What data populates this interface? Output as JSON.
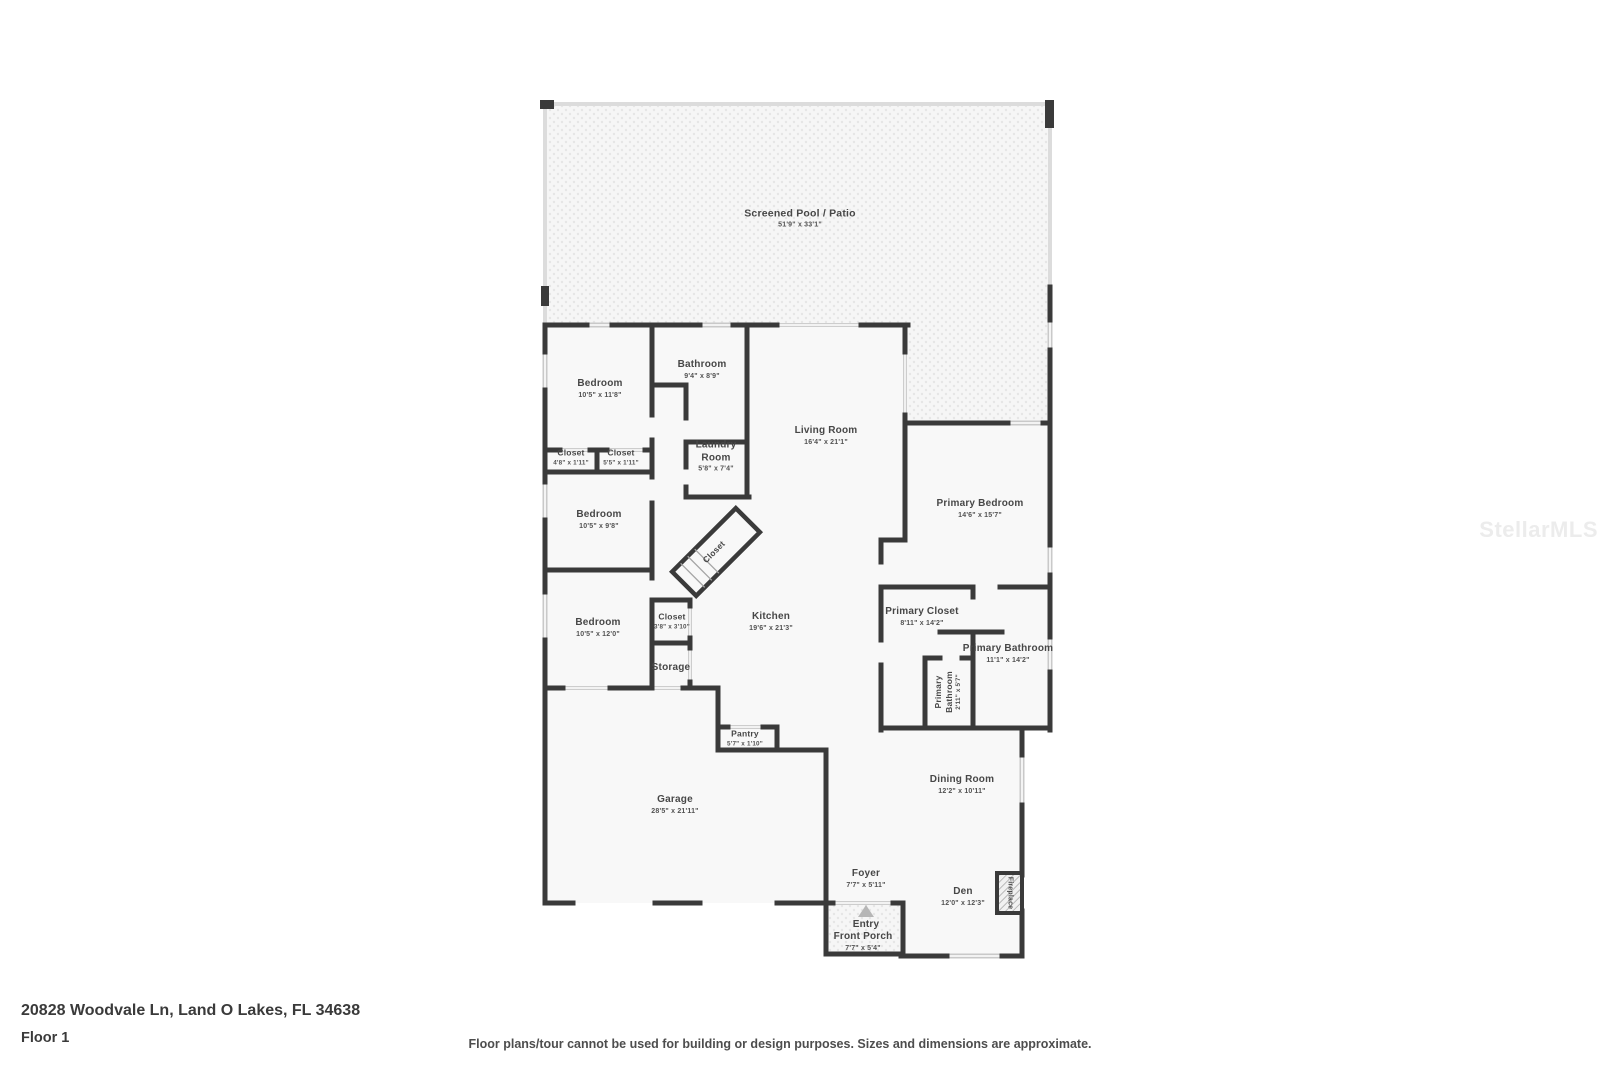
{
  "watermark": "StellarMLS",
  "footer": {
    "address": "20828 Woodvale Ln, Land O Lakes, FL 34638",
    "floor_label": "Floor 1",
    "disclaimer": "Floor plans/tour cannot be used for building or design purposes. Sizes and dimensions are approximate."
  },
  "colors": {
    "wall": "#3a3a3a",
    "window": "#c9c9c9",
    "screen": "#b9b9b9",
    "room_fill": "#f8f8f8",
    "label": "#474747",
    "watermark": "#ececec"
  },
  "plan": {
    "pool": {
      "name": "Screened Pool / Patio",
      "dims": "51'9\" x 33'1\""
    },
    "rooms": {
      "bedroom_top": {
        "name": "Bedroom",
        "dims": "10'5\" x 11'8\""
      },
      "bathroom": {
        "name": "Bathroom",
        "dims": "9'4\" x 8'9\""
      },
      "closet_left": {
        "name": "Closet",
        "dims": "4'8\" x 1'11\""
      },
      "closet_right": {
        "name": "Closet",
        "dims": "5'5\" x 1'11\""
      },
      "laundry": {
        "name": "Laundry Room",
        "dims": "5'8\" x 7'4\""
      },
      "bedroom_mid": {
        "name": "Bedroom",
        "dims": "10'5\" x 9'8\""
      },
      "bedroom_bottom": {
        "name": "Bedroom",
        "dims": "10'5\" x 12'0\""
      },
      "closet_angled": {
        "name": "Closet"
      },
      "closet_hall": {
        "name": "Closet",
        "dims": "3'8\" x 3'10\""
      },
      "storage": {
        "name": "Storage"
      },
      "kitchen": {
        "name": "Kitchen",
        "dims": "19'6\" x 21'3\""
      },
      "living": {
        "name": "Living Room",
        "dims": "16'4\" x 21'1\""
      },
      "primary_bedroom": {
        "name": "Primary Bedroom",
        "dims": "14'6\" x 15'7\""
      },
      "primary_closet": {
        "name": "Primary Closet",
        "dims": "8'11\" x 14'2\""
      },
      "primary_bathroom": {
        "name": "Primary Bathroom",
        "dims": "11'1\" x 14'2\""
      },
      "primary_wc": {
        "name": "Primary Bathroom",
        "dims": "2'11\" x 5'7\""
      },
      "pantry": {
        "name": "Pantry",
        "dims": "5'7\" x 1'10\""
      },
      "garage": {
        "name": "Garage",
        "dims": "28'5\" x 21'11\""
      },
      "dining": {
        "name": "Dining Room",
        "dims": "12'2\" x 10'11\""
      },
      "foyer": {
        "name": "Foyer",
        "dims": "7'7\" x 5'11\""
      },
      "den": {
        "name": "Den",
        "dims": "12'0\" x 12'3\""
      },
      "fireplace": {
        "name": "Fireplace"
      },
      "entry": {
        "name": "Entry"
      },
      "front_porch": {
        "name": "Front Porch",
        "dims": "7'7\" x 5'4\""
      }
    }
  }
}
